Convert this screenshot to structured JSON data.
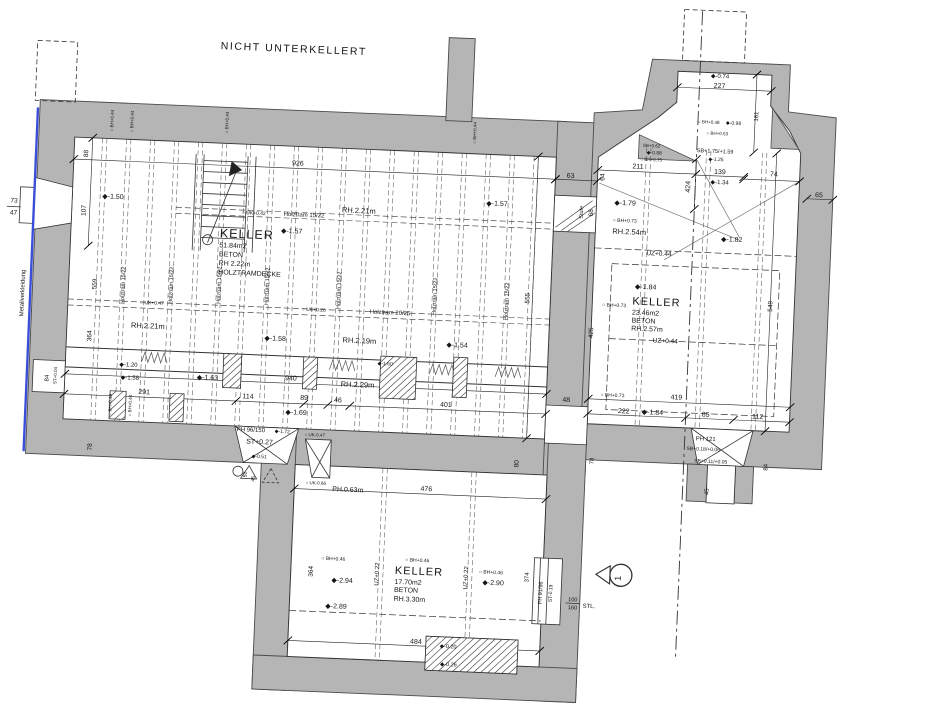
{
  "colors": {
    "wall_gray": "#b5b5b5",
    "line": "#2a2a2a",
    "cladding_blue": "#3a4fd8",
    "paper": "#ffffff"
  },
  "section_marker": {
    "label": "1"
  },
  "rooms": [
    {
      "name": "KELLER",
      "area": "51.84m2",
      "material": "BETON",
      "height": "RH 2.22m",
      "ceiling": "HOLZTRAMDECKE"
    },
    {
      "name": "KELLER",
      "area": "23.46m2",
      "material": "BETON",
      "height": "RH.2.57m"
    },
    {
      "name": "KELLER",
      "area": "17.70m2",
      "material": "BETON",
      "height": "RH.3.30m"
    }
  ],
  "annotations": [
    {
      "n": "plan-title",
      "t": "NICHT UNTERKELLERT",
      "x": 208,
      "y": 60,
      "s": 10.5,
      "cls": "t-title"
    },
    {
      "n": "dim-73",
      "t": "73",
      "x": 8,
      "y": 222,
      "s": 6.5,
      "a": "m"
    },
    {
      "n": "dim-47",
      "t": "47",
      "x": 8,
      "y": 234,
      "s": 6.5,
      "a": "m"
    },
    {
      "n": "metallverkleidung-label",
      "t": "Metallverkleidung",
      "x": 22,
      "y": 312,
      "s": 6,
      "r": -90,
      "a": "m"
    },
    {
      "n": "dim-88",
      "t": "88",
      "x": 80,
      "y": 170,
      "s": 6.5,
      "r": -90,
      "a": "m"
    },
    {
      "n": "dim-107",
      "t": "107",
      "x": 80,
      "y": 227,
      "s": 6.5,
      "r": -90,
      "a": "m"
    },
    {
      "n": "spot-1-50",
      "t": "◆-1.50",
      "x": 96,
      "y": 214,
      "s": 7
    },
    {
      "n": "dim-926",
      "t": "926",
      "x": 290,
      "y": 173,
      "s": 7,
      "a": "m"
    },
    {
      "n": "uk-042",
      "t": "○ UK+0.42",
      "x": 236,
      "y": 224,
      "s": 5
    },
    {
      "n": "holztram-15-22-h",
      "t": "Holztram 15/22",
      "x": 278,
      "y": 224,
      "s": 6
    },
    {
      "n": "rh-221-top",
      "t": "RH.2.21m",
      "x": 336,
      "y": 218,
      "s": 7.5
    },
    {
      "n": "spot-1-57b",
      "t": "◆-1.57",
      "x": 480,
      "y": 205,
      "s": 7
    },
    {
      "n": "spot-1-57a",
      "t": "◆-1.57",
      "x": 276,
      "y": 241,
      "s": 7
    },
    {
      "n": "keller1-name",
      "t": "KELLER",
      "x": 215,
      "y": 248,
      "s": 12.5,
      "cls": "t-room"
    },
    {
      "n": "keller1-area",
      "t": "51.84m2",
      "x": 215,
      "y": 258,
      "s": 7
    },
    {
      "n": "keller1-material",
      "t": "BETON",
      "x": 215,
      "y": 267,
      "s": 7
    },
    {
      "n": "keller1-height",
      "t": "RH 2.22m",
      "x": 215,
      "y": 276,
      "s": 7
    },
    {
      "n": "keller1-ceiling",
      "t": "HOLZTRAMDECKE",
      "x": 215,
      "y": 285,
      "s": 7
    },
    {
      "n": "rh-221-left",
      "t": "RH.2.21m",
      "x": 130,
      "y": 342,
      "s": 7.5
    },
    {
      "n": "dim-559",
      "t": "559",
      "x": 94,
      "y": 300,
      "s": 6.5,
      "r": -90,
      "a": "m"
    },
    {
      "n": "dim-364-left",
      "t": "364",
      "x": 91,
      "y": 352,
      "s": 6.5,
      "r": -90,
      "a": "m"
    },
    {
      "n": "uk-047",
      "t": "○ UK+0.47",
      "x": 138,
      "y": 318,
      "s": 5
    },
    {
      "n": "uk-026",
      "t": "○ UK+0.26",
      "x": 300,
      "y": 318,
      "s": 5
    },
    {
      "n": "holztram-20-25",
      "t": "Holztram 20/25",
      "x": 368,
      "y": 318,
      "s": 6
    },
    {
      "n": "spot-1-58a",
      "t": "◆-1.58",
      "x": 264,
      "y": 349,
      "s": 7
    },
    {
      "n": "rh-219",
      "t": "RH.2.19m",
      "x": 342,
      "y": 348,
      "s": 7.5
    },
    {
      "n": "spot-1-54",
      "t": "◆-1.54",
      "x": 446,
      "y": 348,
      "s": 7
    },
    {
      "n": "spot-1-20",
      "t": "◆-1.20",
      "x": 120,
      "y": 381,
      "s": 6
    },
    {
      "n": "spot-1-58b",
      "t": "◆-1.58",
      "x": 122,
      "y": 394,
      "s": 6
    },
    {
      "n": "spot-1-63",
      "t": "◆-1.63",
      "x": 198,
      "y": 391,
      "s": 7
    },
    {
      "n": "spot-1-60",
      "t": "◆-1.60",
      "x": 378,
      "y": 369,
      "s": 5
    },
    {
      "n": "rh-229",
      "t": "RH.2.29m",
      "x": 342,
      "y": 392,
      "s": 7.5
    },
    {
      "n": "dim-940",
      "t": "940",
      "x": 292,
      "y": 388,
      "s": 7,
      "a": "m"
    },
    {
      "n": "dim-291",
      "t": "291",
      "x": 146,
      "y": 408,
      "s": 7,
      "a": "m"
    },
    {
      "n": "dim-114",
      "t": "114",
      "x": 250,
      "y": 408,
      "s": 7,
      "a": "m"
    },
    {
      "n": "dim-89",
      "t": "89",
      "x": 306,
      "y": 407,
      "s": 7,
      "a": "m"
    },
    {
      "n": "spot-1-69",
      "t": "◆-1.69",
      "x": 288,
      "y": 422,
      "s": 7
    },
    {
      "n": "dim-46",
      "t": "46",
      "x": 340,
      "y": 408,
      "s": 7,
      "a": "m"
    },
    {
      "n": "dim-401",
      "t": "401",
      "x": 448,
      "y": 408,
      "s": 7,
      "a": "m"
    },
    {
      "n": "dim-555",
      "t": "555",
      "x": 527,
      "y": 296,
      "s": 6.5,
      "r": -90,
      "a": "m"
    },
    {
      "n": "dim-80",
      "t": "80",
      "x": 523,
      "y": 462,
      "s": 6.5,
      "r": -90,
      "a": "m"
    },
    {
      "n": "dim-78-left",
      "t": "78",
      "x": 96,
      "y": 463,
      "s": 6.5,
      "r": -90,
      "a": "m"
    },
    {
      "n": "ph-96-150",
      "t": "PH 96/150",
      "x": 240,
      "y": 441,
      "s": 6
    },
    {
      "n": "spot-1-72",
      "t": "◆-1.72",
      "x": 278,
      "y": 441,
      "s": 5
    },
    {
      "n": "st-027",
      "t": "ST+0.27",
      "x": 250,
      "y": 453,
      "s": 7
    },
    {
      "n": "spot-0-51",
      "t": "◆-0.51",
      "x": 256,
      "y": 467,
      "s": 5
    },
    {
      "n": "dim-50",
      "t": "50",
      "x": 252,
      "y": 484,
      "s": 5,
      "r": -90,
      "a": "m"
    },
    {
      "n": "dim-45b",
      "t": "45",
      "x": 260,
      "y": 488,
      "s": 5,
      "r": -90,
      "a": "m"
    },
    {
      "n": "dim-84-niche",
      "t": "84",
      "x": 50,
      "y": 396,
      "s": 6,
      "r": -90,
      "a": "m"
    },
    {
      "n": "st-004",
      "t": "ST+0.04",
      "x": 58,
      "y": 393,
      "s": 4.5,
      "r": -90,
      "a": "m"
    },
    {
      "n": "bh-044-t1",
      "t": "○ BH+0.44",
      "x": 104,
      "y": 136,
      "s": 4.5,
      "r": -90,
      "a": "m"
    },
    {
      "n": "bh-044-t2",
      "t": "○ BH+0.44",
      "x": 124,
      "y": 136,
      "s": 4.5,
      "r": -90,
      "a": "m"
    },
    {
      "n": "bh-044-t3",
      "t": "○ BH+0.44",
      "x": 219,
      "y": 133,
      "s": 4.5,
      "r": -90,
      "a": "m"
    },
    {
      "n": "bh-044-t4",
      "t": "○ BH+0.44",
      "x": 467,
      "y": 133,
      "s": 4.5,
      "r": -90,
      "a": "m"
    },
    {
      "n": "bh-048-b1",
      "t": "○ BH+0.48",
      "x": 114,
      "y": 420,
      "s": 4.5,
      "r": -90,
      "a": "m"
    },
    {
      "n": "bh-044-b2",
      "t": "○ BH+0.44",
      "x": 134,
      "y": 420,
      "s": 4.5,
      "r": -90,
      "a": "m"
    },
    {
      "n": "holztram-v1",
      "t": "Holztram 15/22",
      "x": 122,
      "y": 300,
      "s": 5.5,
      "r": -90,
      "a": "m"
    },
    {
      "n": "holztram-v2",
      "t": "Holztram 15/22",
      "x": 170,
      "y": 298,
      "s": 5.5,
      "r": -90,
      "a": "m"
    },
    {
      "n": "holztram-v3",
      "t": "Holztram 15/22",
      "x": 218,
      "y": 296,
      "s": 5.5,
      "r": -90,
      "a": "m"
    },
    {
      "n": "holztram-v4",
      "t": "Holztram 15/22",
      "x": 266,
      "y": 295,
      "s": 5.5,
      "r": -90,
      "a": "m"
    },
    {
      "n": "holztram-v5",
      "t": "Holztram 15/22",
      "x": 338,
      "y": 296,
      "s": 5.5,
      "r": -90,
      "a": "m"
    },
    {
      "n": "holztram-v6",
      "t": "Holztram 15/22",
      "x": 434,
      "y": 298,
      "s": 5.5,
      "r": -90,
      "a": "m"
    },
    {
      "n": "holztram-v7",
      "t": "Holztram 15/22",
      "x": 506,
      "y": 300,
      "s": 5.5,
      "r": -90,
      "a": "m"
    },
    {
      "n": "dim-63",
      "t": "63",
      "x": 563,
      "y": 174,
      "s": 7,
      "a": "m"
    },
    {
      "n": "dim-64",
      "t": "64",
      "x": 597,
      "y": 172,
      "s": 6.5,
      "r": -90,
      "a": "m"
    },
    {
      "n": "stufe-label",
      "t": "Stufe",
      "x": 577,
      "y": 208,
      "s": 5.5,
      "r": -90,
      "a": "m"
    },
    {
      "n": "dim-68",
      "t": "68",
      "x": 587,
      "y": 208,
      "s": 6.5,
      "r": -90,
      "a": "m"
    },
    {
      "n": "dim-211",
      "t": "211",
      "x": 630,
      "y": 162,
      "s": 7,
      "a": "m"
    },
    {
      "n": "spot-1-79",
      "t": "◆-1.79",
      "x": 608,
      "y": 199,
      "s": 7
    },
    {
      "n": "bh-073-a",
      "t": "○ BH+0.73",
      "x": 607,
      "y": 216,
      "s": 5
    },
    {
      "n": "rh-254",
      "t": "RH.2.54m",
      "x": 607,
      "y": 228,
      "s": 7.5
    },
    {
      "n": "dim-424",
      "t": "424",
      "x": 683,
      "y": 178,
      "s": 7,
      "r": -90,
      "a": "m"
    },
    {
      "n": "spot-1-82",
      "t": "◆-1.82",
      "x": 716,
      "y": 231,
      "s": 7
    },
    {
      "n": "dim-139",
      "t": "139",
      "x": 712,
      "y": 164,
      "s": 7,
      "a": "m"
    },
    {
      "n": "spot-1-34",
      "t": "◆-1.34",
      "x": 703,
      "y": 174,
      "s": 6
    },
    {
      "n": "sb-175-159",
      "t": "SB+1.75/+1.59",
      "x": 688,
      "y": 143,
      "s": 5.5
    },
    {
      "n": "spot-1-25",
      "t": "◆-1.25",
      "x": 700,
      "y": 151,
      "s": 5
    },
    {
      "n": "dim-227",
      "t": "227",
      "x": 708,
      "y": 78,
      "s": 7,
      "a": "m"
    },
    {
      "n": "spot-0-74",
      "t": "◆-0.74",
      "x": 699,
      "y": 68,
      "s": 6
    },
    {
      "n": "dim-161",
      "t": "161",
      "x": 748,
      "y": 105,
      "s": 6,
      "r": -90,
      "a": "m"
    },
    {
      "n": "bh-048-bay",
      "t": "○ BH+0.48",
      "x": 688,
      "y": 114,
      "s": 4.5
    },
    {
      "n": "spot-0-98",
      "t": "◆-0.98",
      "x": 716,
      "y": 114,
      "s": 5
    },
    {
      "n": "bh-053",
      "t": "○ BH+0.53",
      "x": 697,
      "y": 125,
      "s": 4.5
    },
    {
      "n": "sb-062",
      "t": "SB+0.62",
      "x": 634,
      "y": 140,
      "s": 4.5
    },
    {
      "n": "spot-0-88",
      "t": "◆-0.88",
      "x": 638,
      "y": 147,
      "s": 5
    },
    {
      "n": "bh-075",
      "t": "○ BH+0.75",
      "x": 632,
      "y": 154,
      "s": 4.5
    },
    {
      "n": "dim-74",
      "t": "74",
      "x": 766,
      "y": 164,
      "s": 7,
      "a": "m"
    },
    {
      "n": "dim-65",
      "t": "65",
      "x": 812,
      "y": 183,
      "s": 7,
      "a": "m"
    },
    {
      "n": "uz-044-a",
      "t": "UZ+0.44",
      "x": 642,
      "y": 248,
      "s": 6.5
    },
    {
      "n": "spot-1-84a",
      "t": "◆-1.84",
      "x": 632,
      "y": 282,
      "s": 7
    },
    {
      "n": "keller2-name",
      "t": "KELLER",
      "x": 630,
      "y": 298,
      "s": 11,
      "cls": "t-room"
    },
    {
      "n": "keller2-area",
      "t": "23.46m2",
      "x": 630,
      "y": 308,
      "s": 7
    },
    {
      "n": "keller2-material",
      "t": "BETON",
      "x": 630,
      "y": 316,
      "s": 7
    },
    {
      "n": "keller2-height",
      "t": "RH.2.57m",
      "x": 630,
      "y": 324,
      "s": 7
    },
    {
      "n": "bh-073-b",
      "t": "○ BH+0.73",
      "x": 600,
      "y": 301,
      "s": 5
    },
    {
      "n": "dim-549",
      "t": "549",
      "x": 770,
      "y": 294,
      "s": 6.5,
      "r": -90,
      "a": "m"
    },
    {
      "n": "uz-044-b",
      "t": "UZ+0.44",
      "x": 652,
      "y": 335,
      "s": 6.5
    },
    {
      "n": "dim-425",
      "t": "425",
      "x": 592,
      "y": 328,
      "s": 6.5,
      "r": -90,
      "a": "m"
    },
    {
      "n": "bh-073-c",
      "t": "○ BH+0.73",
      "x": 602,
      "y": 391,
      "s": 5
    },
    {
      "n": "dim-419",
      "t": "419",
      "x": 678,
      "y": 391,
      "s": 7,
      "a": "m"
    },
    {
      "n": "dim-222",
      "t": "222",
      "x": 626,
      "y": 407,
      "s": 7,
      "a": "m"
    },
    {
      "n": "spot-1-84b",
      "t": "◆-1.84",
      "x": 644,
      "y": 407,
      "s": 7
    },
    {
      "n": "dim-85",
      "t": "85",
      "x": 708,
      "y": 407,
      "s": 7,
      "a": "m"
    },
    {
      "n": "dim-112",
      "t": "112",
      "x": 760,
      "y": 407,
      "s": 7,
      "a": "m"
    },
    {
      "n": "ph-121",
      "t": "PH 121",
      "x": 709,
      "y": 431,
      "s": 6,
      "a": "m"
    },
    {
      "n": "sb-018-006",
      "t": "SB+0.18/+0.06",
      "x": 707,
      "y": 441,
      "s": 5,
      "a": "m"
    },
    {
      "n": "sb-011-005",
      "t": "SB+0.11/+0.05",
      "x": 715,
      "y": 453,
      "s": 5,
      "a": "m"
    },
    {
      "n": "dim-45",
      "t": "45",
      "x": 714,
      "y": 482,
      "s": 6,
      "r": -90,
      "a": "m"
    },
    {
      "n": "dim-84-r",
      "t": "84",
      "x": 772,
      "y": 455,
      "s": 6,
      "r": -90,
      "a": "m"
    },
    {
      "n": "dim-78-r",
      "t": "78",
      "x": 598,
      "y": 456,
      "s": 6,
      "r": -90,
      "a": "m"
    },
    {
      "n": "dim-48",
      "t": "48",
      "x": 568,
      "y": 398,
      "s": 7,
      "a": "m"
    },
    {
      "n": "uk-047-b",
      "t": "○ UK-0.47",
      "x": 308,
      "y": 443,
      "s": 4.5
    },
    {
      "n": "uk-066",
      "t": "○ UK-0.66",
      "x": 311,
      "y": 491,
      "s": 4.5
    },
    {
      "n": "ph-063",
      "t": "PH.0.63m",
      "x": 338,
      "y": 497,
      "s": 7
    },
    {
      "n": "dim-476",
      "t": "476",
      "x": 432,
      "y": 493,
      "s": 7,
      "a": "m"
    },
    {
      "n": "dim-364-b",
      "t": "364",
      "x": 322,
      "y": 578,
      "s": 6.5,
      "r": -90,
      "a": "m"
    },
    {
      "n": "bh-046-a",
      "t": "○ BH+0.46",
      "x": 330,
      "y": 566,
      "s": 5
    },
    {
      "n": "spot-2-94",
      "t": "◆-2.94",
      "x": 341,
      "y": 588,
      "s": 7
    },
    {
      "n": "spot-2-89",
      "t": "◆-2.89",
      "x": 336,
      "y": 614,
      "s": 7
    },
    {
      "n": "uz-022-a",
      "t": "UZ+0.22",
      "x": 388,
      "y": 578,
      "s": 6,
      "r": -90,
      "a": "m"
    },
    {
      "n": "bh-046-b",
      "t": "○ BH+0.46",
      "x": 414,
      "y": 564,
      "s": 5
    },
    {
      "n": "keller3-name",
      "t": "KELLER",
      "x": 404,
      "y": 577,
      "s": 11,
      "cls": "t-room"
    },
    {
      "n": "keller3-area",
      "t": "17.70m2",
      "x": 404,
      "y": 587,
      "s": 7
    },
    {
      "n": "keller3-material",
      "t": "BETON",
      "x": 404,
      "y": 595,
      "s": 7
    },
    {
      "n": "keller3-height",
      "t": "RH.3.30m",
      "x": 404,
      "y": 604,
      "s": 7
    },
    {
      "n": "uz-022-b",
      "t": "UZ+0.22",
      "x": 477,
      "y": 578,
      "s": 6,
      "r": -90,
      "a": "m"
    },
    {
      "n": "bh-046-c",
      "t": "○ BH+0.46",
      "x": 488,
      "y": 573,
      "s": 5
    },
    {
      "n": "spot-2-90",
      "t": "◆-2.90",
      "x": 492,
      "y": 584,
      "s": 7
    },
    {
      "n": "dim-374",
      "t": "374",
      "x": 538,
      "y": 575,
      "s": 6,
      "r": -90,
      "a": "m"
    },
    {
      "n": "ph-91-96",
      "t": "PH 91/96",
      "x": 552,
      "y": 590,
      "s": 5.5,
      "r": -90,
      "a": "m"
    },
    {
      "n": "st-019",
      "t": "ST-0.19",
      "x": 562,
      "y": 590,
      "s": 5,
      "r": -90,
      "a": "m"
    },
    {
      "n": "dim-100",
      "t": "100",
      "x": 583,
      "y": 597,
      "s": 5.5,
      "a": "m"
    },
    {
      "n": "dim-160",
      "t": "160",
      "x": 583,
      "y": 605,
      "s": 5.5,
      "a": "m"
    },
    {
      "n": "stl-label",
      "t": "STL.",
      "x": 593,
      "y": 603,
      "s": 6
    },
    {
      "n": "dim-484",
      "t": "484",
      "x": 428,
      "y": 646,
      "s": 7,
      "a": "m"
    },
    {
      "n": "spot-0-20",
      "t": "◆-0.20",
      "x": 452,
      "y": 649,
      "s": 5.5
    },
    {
      "n": "spot-0-26",
      "t": "◆-0.26",
      "x": 453,
      "y": 667,
      "s": 5.5
    },
    {
      "n": "section-number",
      "t": "1",
      "x": 630,
      "y": 572,
      "s": 9,
      "r": -90,
      "a": "m"
    }
  ]
}
